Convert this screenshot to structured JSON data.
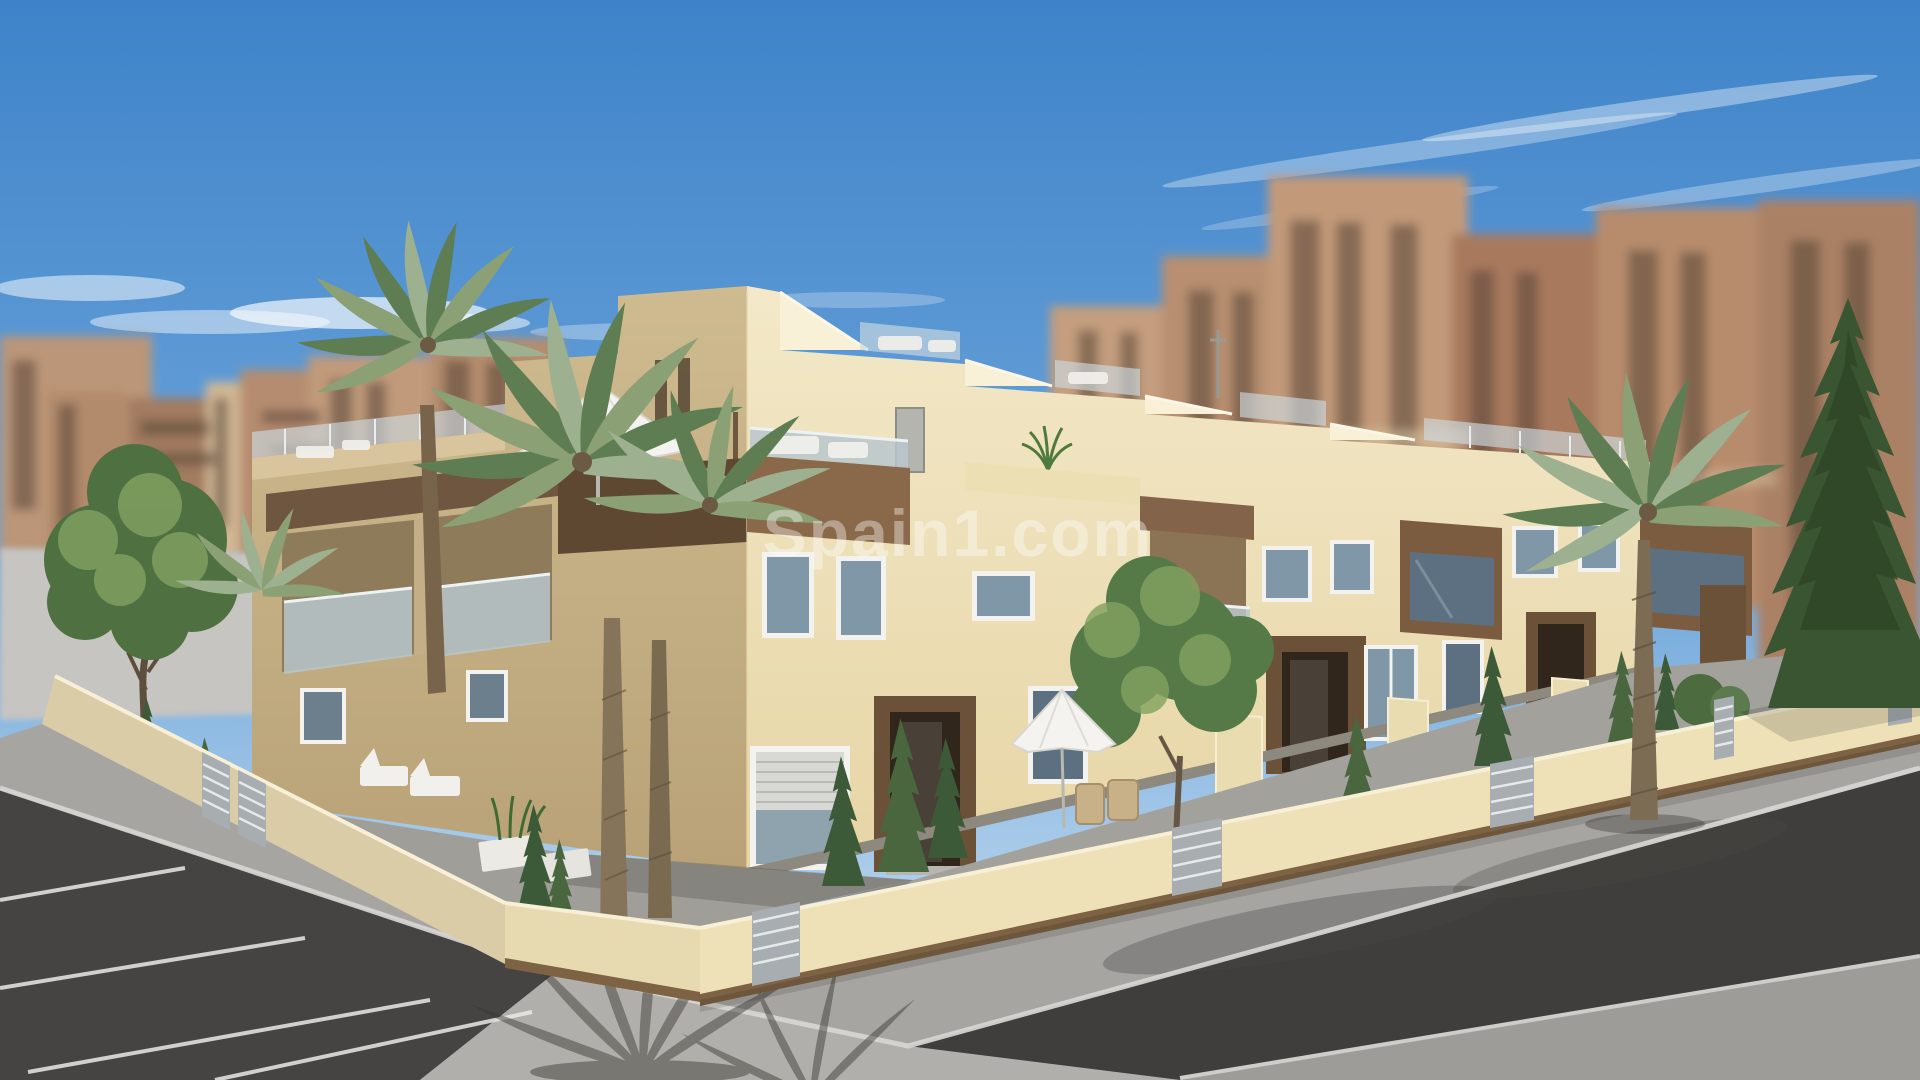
{
  "meta": {
    "image_kind": "3d-architectural-render",
    "description": "Computer generated marketing render of a new-build corner row of two-storey cream townhouses with wooden accents, glass balconies, roof terraces, palm trees and walled front gardens; blurred apartment towers behind, asphalt road and parking bays in the foreground"
  },
  "watermark": {
    "text": "Spain1.com",
    "color": "#ffffff",
    "opacity": 0.38
  },
  "palette": {
    "sky_top": "#3e83c9",
    "sky_mid": "#6aa3da",
    "sky_pale": "#a6c9e8",
    "sky_horizon": "#c8def2",
    "cloud": "#ffffff",
    "bg_tower_tan": "#c09a7a",
    "bg_tower_salmon": "#b68c70",
    "bg_tower_brown": "#a37c61",
    "bg_tower_cream": "#d1b794",
    "bg_window_dark": "#584639",
    "facade_sunlit_hi": "#f3e8c8",
    "facade_sunlit_lo": "#e6d5a5",
    "facade_shade_hi": "#cfbb90",
    "facade_shade_lo": "#b9a277",
    "wood_sunlit": "#8a684a",
    "wood_shaded": "#5f4832",
    "door_interior": "#31261c",
    "glass_balustrade": "#b9c7cd",
    "window_glass": "#7f97a6",
    "window_frame": "#f3f2ee",
    "roller_shutter": "#d8d8d4",
    "garden_wall_front": "#eee1b8",
    "garden_wall_bevel": "#e8dab0",
    "garden_wall_west": "#d9cca6",
    "wall_base_wood": "#7d6244",
    "fence_gray": "#a7adb0",
    "sidewalk": "#a7a5a1",
    "apron": "#b1afab",
    "road": "#3f3e3c",
    "parking": "#454442",
    "near_sidewalk": "#9e9c98",
    "pale_ground": "#c6c5c1",
    "lawn_green": "#6d8f55",
    "tree_green": "#4f7040",
    "tree_highlight": "#7fa05f",
    "palm_green": "#5f7d52",
    "palm_gray_green": "#9db08f",
    "palm_trunk": "#77644b",
    "conifer_green": "#3a5531",
    "parasol_white": "#f4f3ef",
    "wicker_tan": "#c8b089"
  },
  "objects": [
    {
      "name": "sky",
      "label": "blue sky with wispy clouds"
    },
    {
      "name": "background-apartment-towers",
      "label": "blurred tan and salmon apartment blocks"
    },
    {
      "name": "townhouse-row",
      "label": "two-storey cream townhouses on a corner plot"
    },
    {
      "name": "corner-tower",
      "label": "tall stair-tower block at the corner unit"
    },
    {
      "name": "roof-terraces",
      "label": "stepped parapets with glass railings"
    },
    {
      "name": "roof-parasol",
      "label": "white parasol on roof terrace"
    },
    {
      "name": "garden-parasol",
      "label": "white parasol with wicker chairs in front garden"
    },
    {
      "name": "wood-balconies",
      "label": "timber-clad balcony boxes with glass fronts"
    },
    {
      "name": "entrance-portals",
      "label": "recessed entrances with timber surrounds"
    },
    {
      "name": "garden-wall",
      "label": "cream boundary wall with grey slatted fence panels"
    },
    {
      "name": "palm-trees",
      "label": "tall palms in gardens and on the pavement"
    },
    {
      "name": "deciduous-trees",
      "label": "leafy green garden trees"
    },
    {
      "name": "conifer-tree",
      "label": "tall pine at the right edge"
    },
    {
      "name": "sidewalk",
      "label": "light grey pavement around the plot"
    },
    {
      "name": "road",
      "label": "dark asphalt street"
    },
    {
      "name": "parking-bays",
      "label": "asphalt parking with white bay lines"
    },
    {
      "name": "watermark",
      "label": "Spain1.com overlay"
    }
  ]
}
